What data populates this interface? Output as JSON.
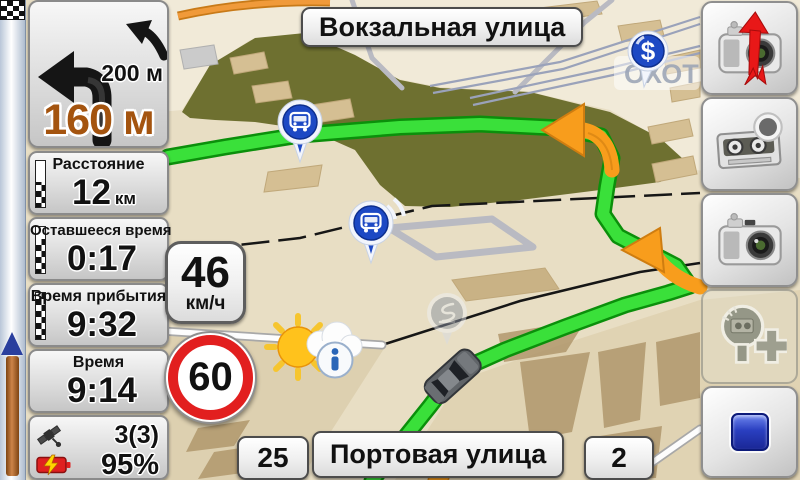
{
  "turn_panel": {
    "next_maneuver_distance": "200 м",
    "maneuver_distance": "160 м"
  },
  "info_panels": [
    {
      "label": "Расстояние",
      "value": "12",
      "unit": "км"
    },
    {
      "label": "Оставшееся время",
      "value": "0:17",
      "unit": ""
    },
    {
      "label": "Время прибытия",
      "value": "9:32",
      "unit": ""
    },
    {
      "label": "Время",
      "value": "9:14",
      "unit": ""
    }
  ],
  "status": {
    "satellites": "3(3)",
    "battery": "95%"
  },
  "speedometer": {
    "value": "46",
    "unit": "км/ч"
  },
  "speed_limit": {
    "value": "60"
  },
  "streets": {
    "current": "Вокзальная улица",
    "next": "Портовая улица",
    "house_number_left": "25",
    "house_number_right": "2"
  },
  "map": {
    "poi_label": "ОХОТ",
    "currency_pin_symbol": "$"
  },
  "colors": {
    "route": "#3ae03a",
    "maneuver_arrow": "#f89d1c",
    "distance_text": "#a4540f",
    "speed_limit_ring": "#e21f1f",
    "poi_pin_blue": "#1d49c4",
    "park": "#6e7030",
    "battery": "#e02020",
    "progress_fill": "#c07a3c"
  }
}
